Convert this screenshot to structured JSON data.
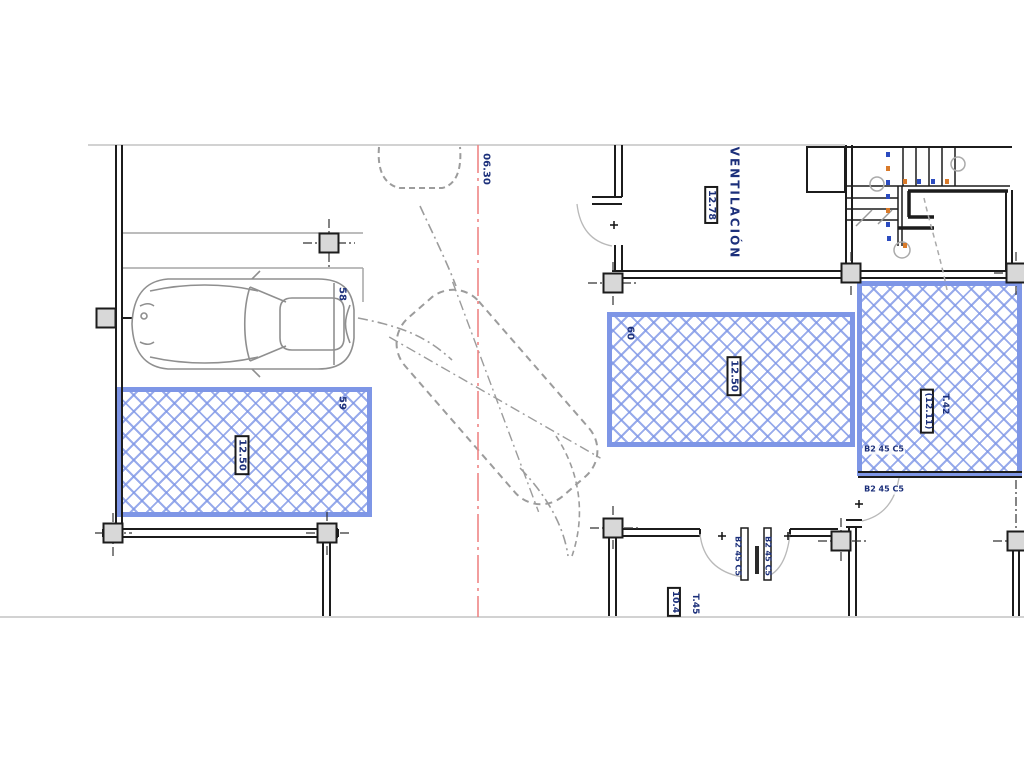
{
  "plan": {
    "centerline_label": "06.30",
    "room": {
      "name": "VENTILACIÓN",
      "area": "12.78"
    },
    "stalls": {
      "s58": {
        "id": "58"
      },
      "s59": {
        "id": "59",
        "area": "12.50"
      },
      "s60": {
        "id": "60",
        "area": "12.50"
      },
      "t42": {
        "id": "T.42",
        "area": "(12.11)"
      },
      "t45": {
        "id": "T.45",
        "area": "10.4"
      }
    },
    "door_spec": "B2 45 C5",
    "colors": {
      "hatch_border": "#7e96e6",
      "hatch_line": "#9db1ee",
      "label_navy": "#1b2f7a",
      "centerline_red": "#ef8585",
      "wall_black": "#1c1c1c"
    }
  }
}
